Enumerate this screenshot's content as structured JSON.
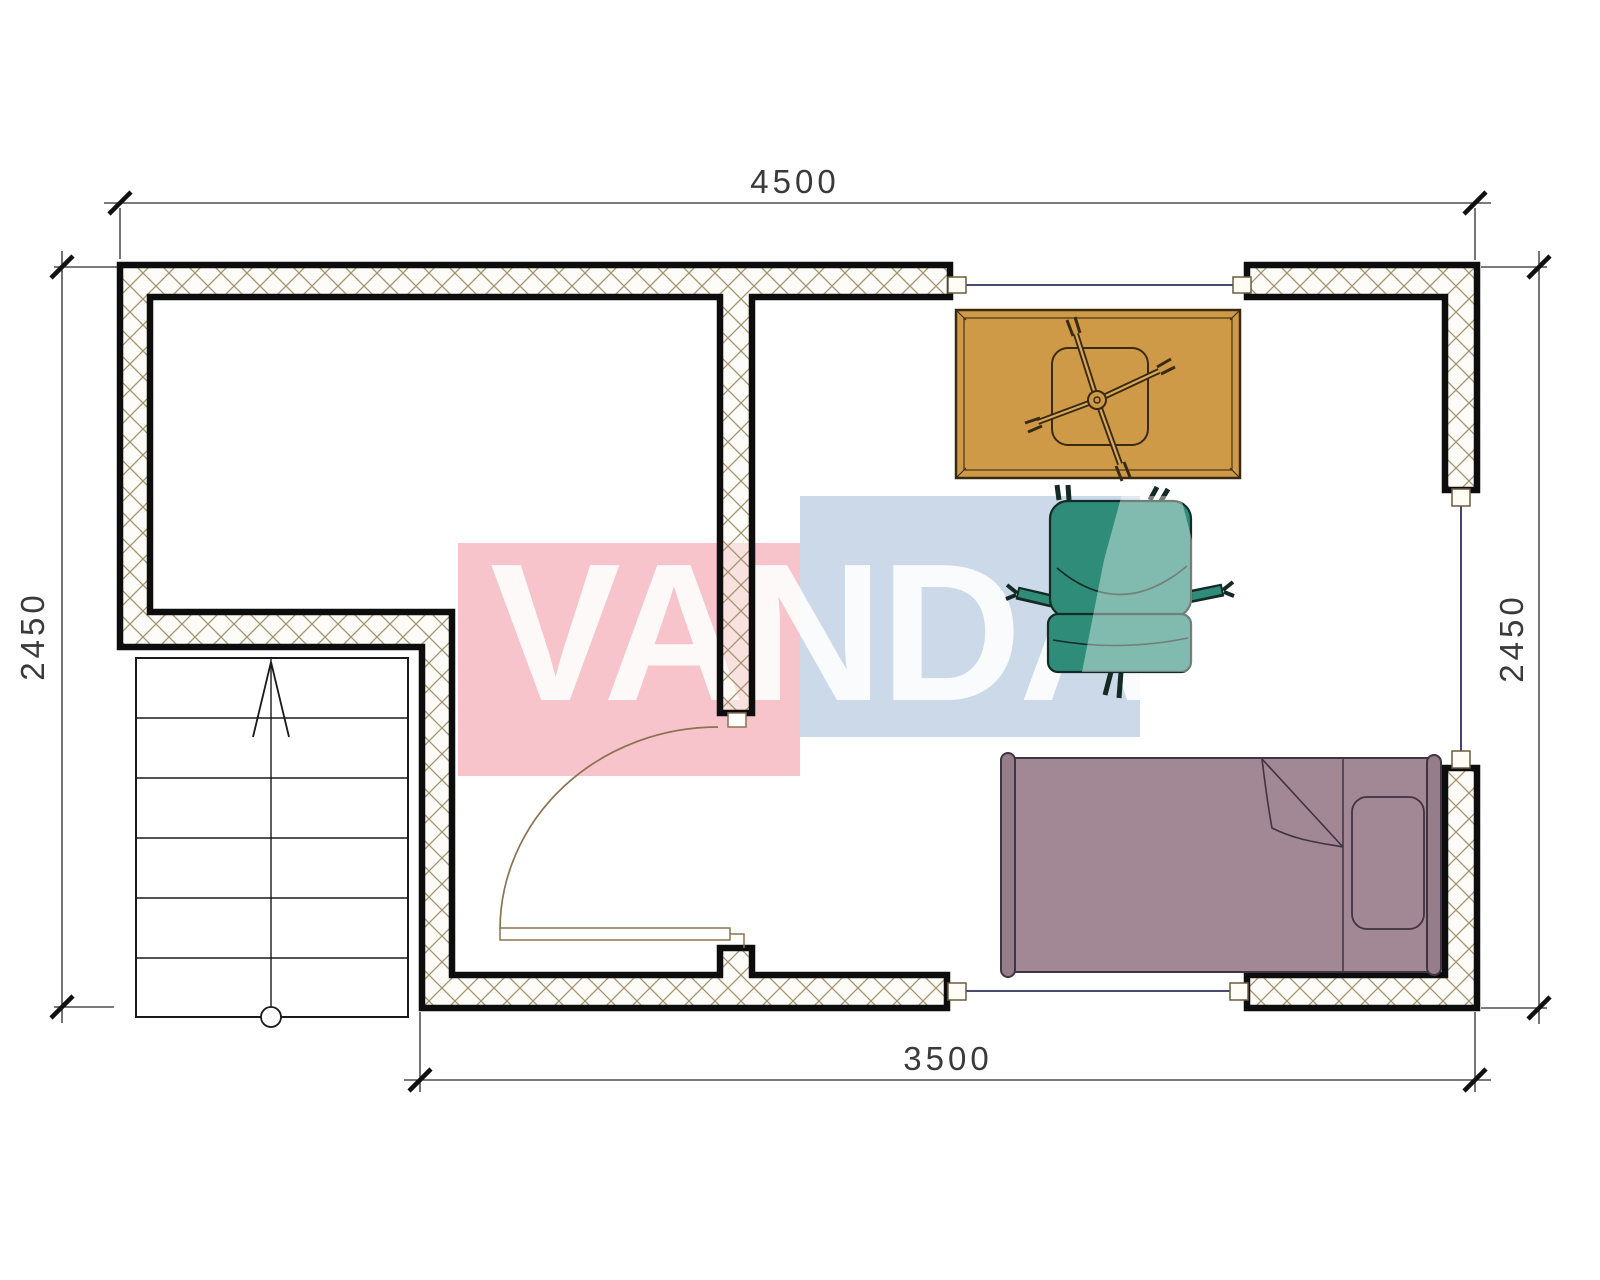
{
  "title": "apartment-floor-plan",
  "watermark": {
    "text": "VANDA",
    "pink": "#f6c4ca",
    "blue": "#cbd9e9",
    "text_color": "#ffffff"
  },
  "dimensions": {
    "top": "4500",
    "bottom": "3500",
    "left": "2450",
    "right": "2450"
  },
  "plan": {
    "wall_fill": "#fcf9f2",
    "hatch_line_color": "#a4926c",
    "wall_border_color": "#0d0d0d",
    "window_line_color": "#2f2f63",
    "door_line_color": "#8a7350",
    "stairs_line_color": "#1a1a1a"
  },
  "furniture": {
    "table": {
      "name": "table-with-fan",
      "fill": "#ce9a48",
      "line": "#3a2a10",
      "inner_line": "#d8aa5c"
    },
    "chair": {
      "name": "armchair",
      "fill": "#2e8c79",
      "line": "#142a24"
    },
    "bed": {
      "name": "single-bed",
      "fill": "#a28794",
      "frame_fill": "#967d8a",
      "line": "#403343"
    }
  }
}
